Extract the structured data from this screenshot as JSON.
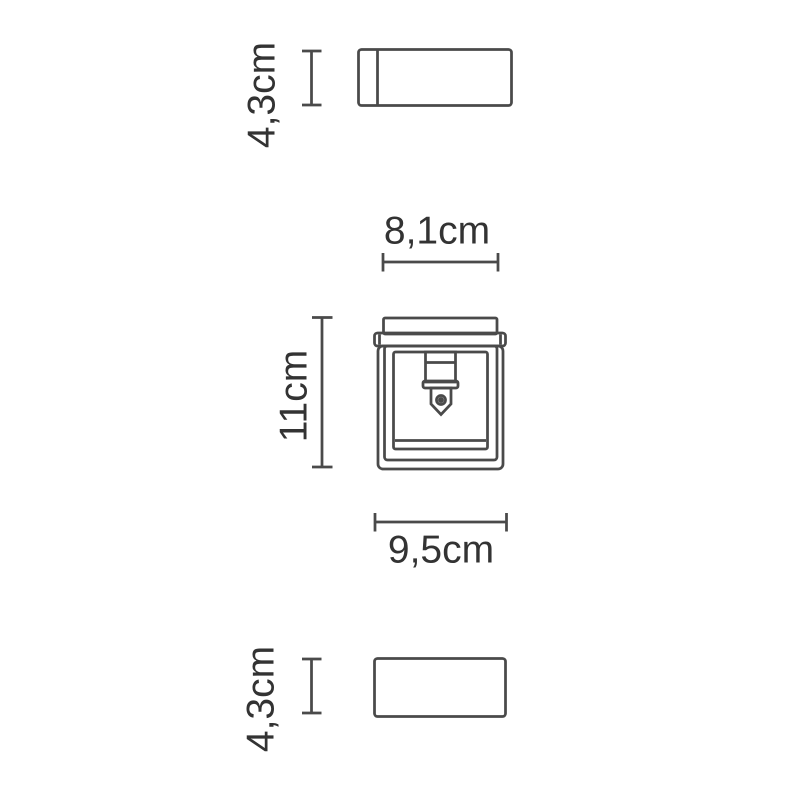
{
  "diagram": {
    "type": "product-dimension-drawing",
    "labels": {
      "upper_section_height": "4,3cm",
      "plate_width": "8,1cm",
      "body_height": "11cm",
      "body_width": "9,5cm",
      "lower_section_height": "4,3cm"
    },
    "colors": {
      "line": "#4a4a4a",
      "text": "#333333",
      "background": "#ffffff"
    }
  }
}
